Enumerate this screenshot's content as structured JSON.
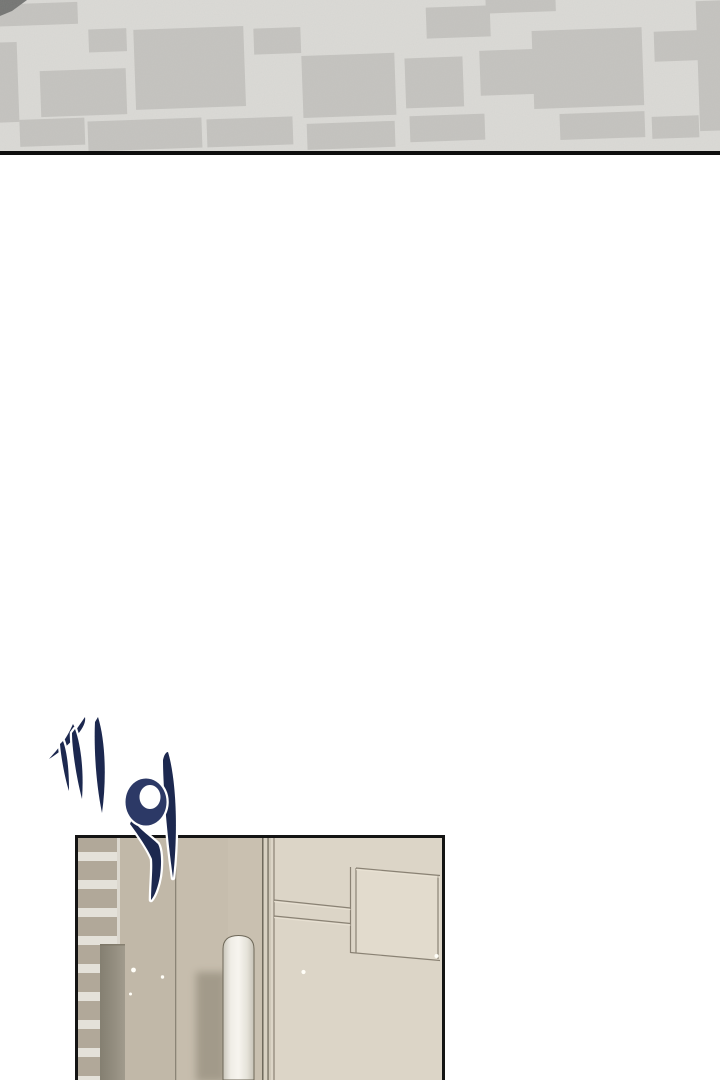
{
  "page": {
    "width": 720,
    "height": 1080,
    "background": "#ffffff"
  },
  "sfx": {
    "text": "끼익",
    "role": "hand-lettered sound effect",
    "color": "#1c284f",
    "color_mid": "#2c3966",
    "outline_color": "#ffffff"
  },
  "top_panel": {
    "name": "patterned ceiling/floor texture",
    "base_color": "#dcdbd7",
    "block_color": "#c5c4c0",
    "corner_shadow_color": "#737472",
    "border_line_color": "#0e0e0e"
  },
  "hallway_panel": {
    "name": "interior hallway with door paneling",
    "border_color": "#141414",
    "wall_color": "#c6bdad",
    "wall_light_color": "#dcd5c7",
    "stripe_dark": "#b1a899",
    "stripe_light": "#e4e1d9",
    "pillar_gray": "#8b8678",
    "cylinder_white": "#f7f5ef",
    "groove_color": "#8a8274",
    "frame_line_color": "#6f6a5d"
  }
}
